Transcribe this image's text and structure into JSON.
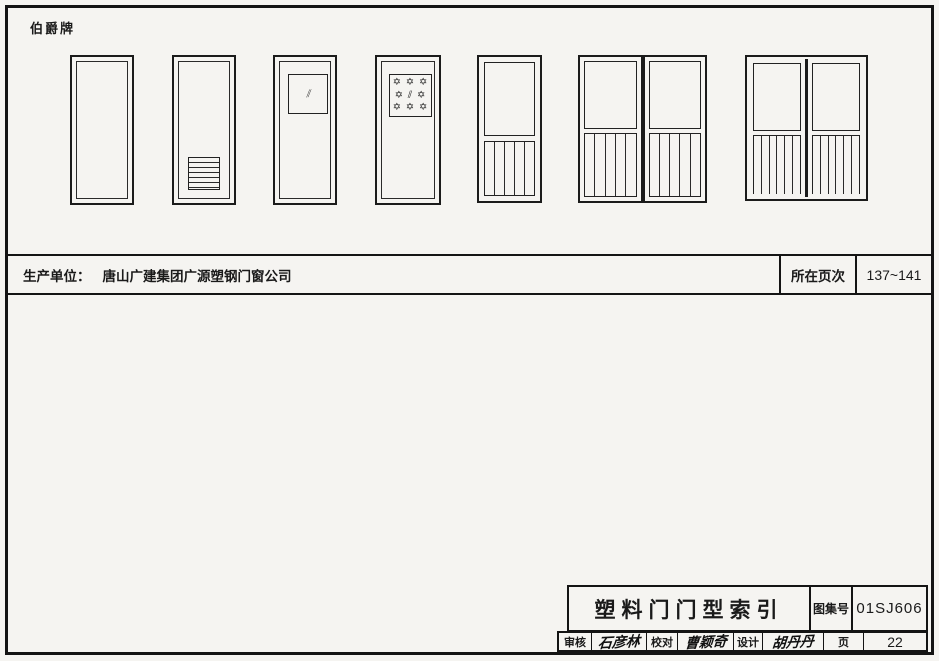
{
  "page": {
    "brand": "伯爵牌",
    "producer_row": {
      "label": "生产单位：",
      "company": "唐山广建集团广源塑钢门窗公司",
      "page_range_label": "所在页次",
      "page_range": "137~141"
    },
    "title_block": {
      "title": "塑料门门型索引",
      "atlas_no_label": "图集号",
      "atlas_no": "01SJ606",
      "review_label": "审核",
      "review_signature": "石彦林",
      "proof_label": "校对",
      "proof_signature": "曹颖奇",
      "design_label": "设计",
      "design_signature": "胡丹丹",
      "page_label": "页",
      "page_no": "22"
    },
    "doors": [
      {
        "id": "door-1",
        "type": "flush-panel-door"
      },
      {
        "id": "door-2",
        "type": "door-with-bottom-louver"
      },
      {
        "id": "door-3",
        "type": "door-with-top-glass-vision-panel"
      },
      {
        "id": "door-4",
        "type": "door-with-decorative-star-glass-panel"
      },
      {
        "id": "door-5",
        "type": "half-glass-door-with-lower-battens"
      },
      {
        "id": "door-6",
        "type": "double-leaf-half-glass-door-with-lower-battens"
      },
      {
        "id": "door-7",
        "type": "double-door-shared-frame-half-glass-with-lower-battens"
      }
    ],
    "icons": {
      "glass_hatch": "⫽",
      "star_row": "✡ ✡ ✡",
      "star_row_mid": "✡ ⫽ ✡"
    },
    "colors": {
      "line": "#141414",
      "paper": "#f5f4f1"
    }
  }
}
